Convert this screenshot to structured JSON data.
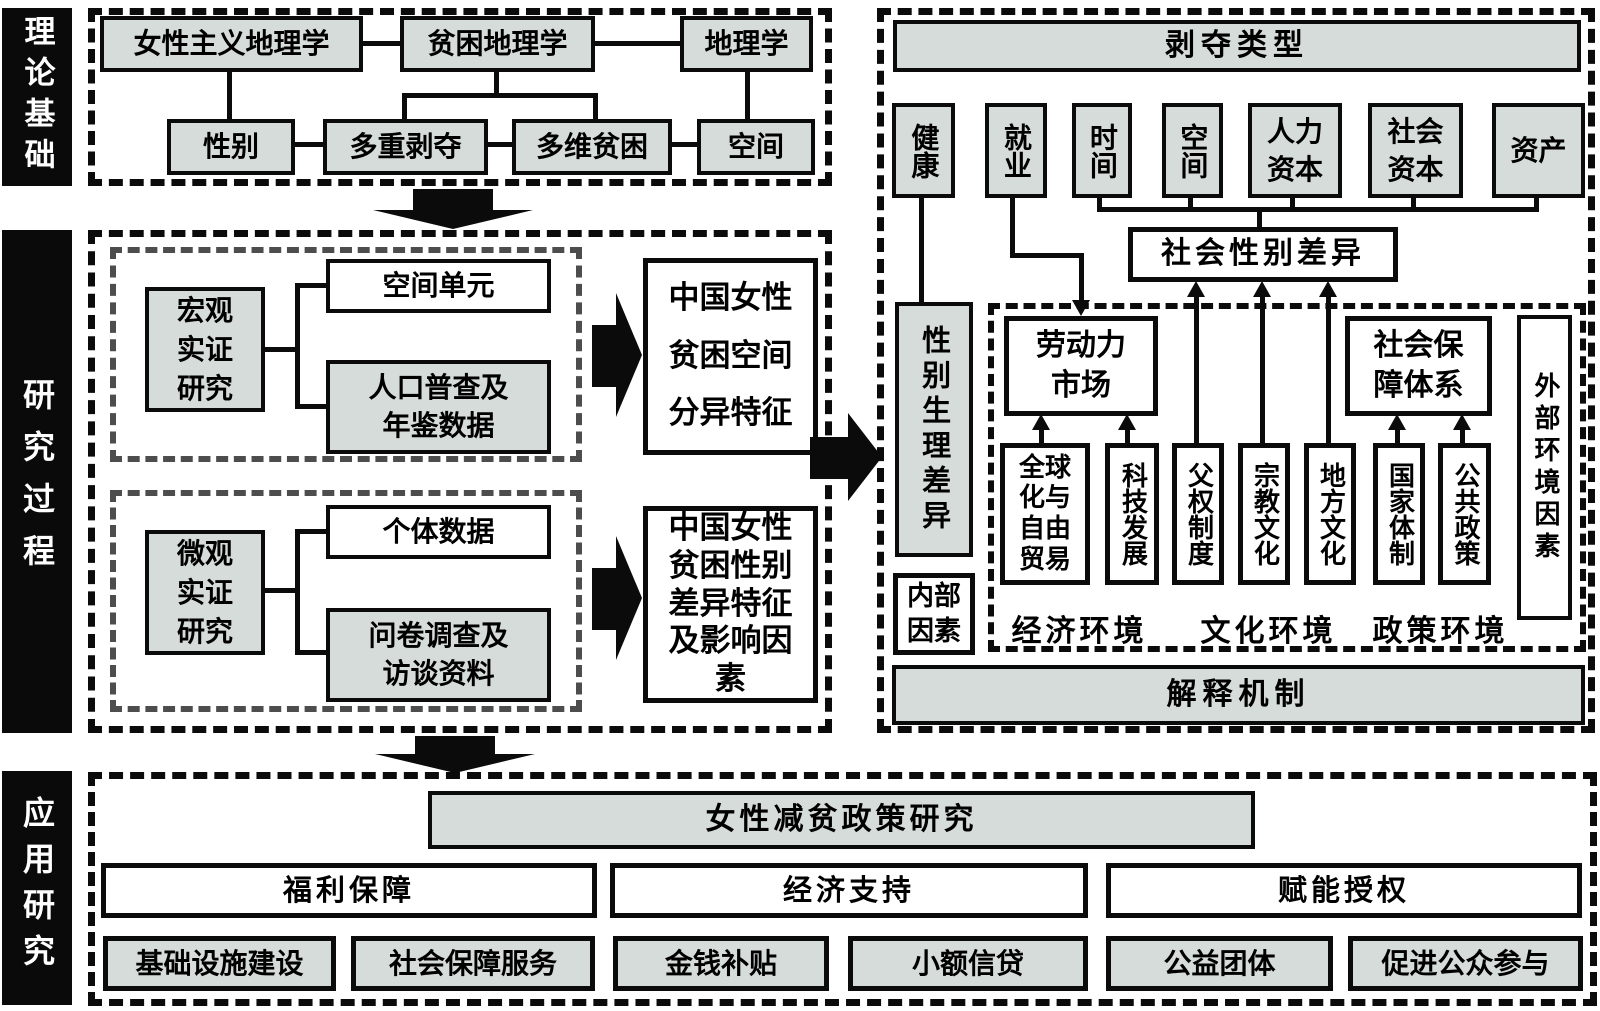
{
  "colors": {
    "box_fill_gray": "#d6dcd9",
    "box_fill_white": "#ffffff",
    "line_black": "#0b0b0b",
    "inner_dash_gray": "#4d4d4d",
    "sidebar_black": "#0a0a0a"
  },
  "sidebars": {
    "theory": "理论基础",
    "process": "研究过程",
    "application": "应用研究"
  },
  "theory": {
    "feminist_geography": "女性主义地理学",
    "poverty_geography": "贫困地理学",
    "geography": "地理学",
    "gender": "性别",
    "multiple_deprivation": "多重剥夺",
    "multidim_poverty": "多维贫困",
    "space": "空间"
  },
  "process": {
    "macro_title": "宏观\n实证\n研究",
    "spatial_unit": "空间单元",
    "census_data": "人口普查及\n年鉴数据",
    "macro_result": "中国女性\n贫困空间\n分异特征",
    "micro_title": "微观\n实证\n研究",
    "individual_data": "个体数据",
    "survey_data": "问卷调查及\n访谈资料",
    "micro_result": "中国女性\n贫困性别\n差异特征\n及影响因\n素"
  },
  "mechanism": {
    "deprivation_title": "剥夺类型",
    "types": [
      "健康",
      "就业",
      "时间",
      "空间",
      "人力\n资本",
      "社会\n资本",
      "资产"
    ],
    "social_gender_diff": "社会性别差异",
    "physio_diff": "性别生理差异",
    "internal_factors": "内部\n因素",
    "labor_market": "劳动力\n市场",
    "social_security": "社会保\n障体系",
    "external_factors": "外部环境因素",
    "factors": [
      "全球\n化与\n自由\n贸易",
      "科技发展",
      "父权制度",
      "宗教文化",
      "地方文化",
      "国家体制",
      "公共政策"
    ],
    "environments": [
      "经济环境",
      "文化环境",
      "政策环境"
    ],
    "explanation": "解释机制"
  },
  "application": {
    "title": "女性减贫政策研究",
    "categories": [
      "福利保障",
      "经济支持",
      "赋能授权"
    ],
    "measures": [
      "基础设施建设",
      "社会保障服务",
      "金钱补贴",
      "小额信贷",
      "公益团体",
      "促进公众参与"
    ]
  }
}
